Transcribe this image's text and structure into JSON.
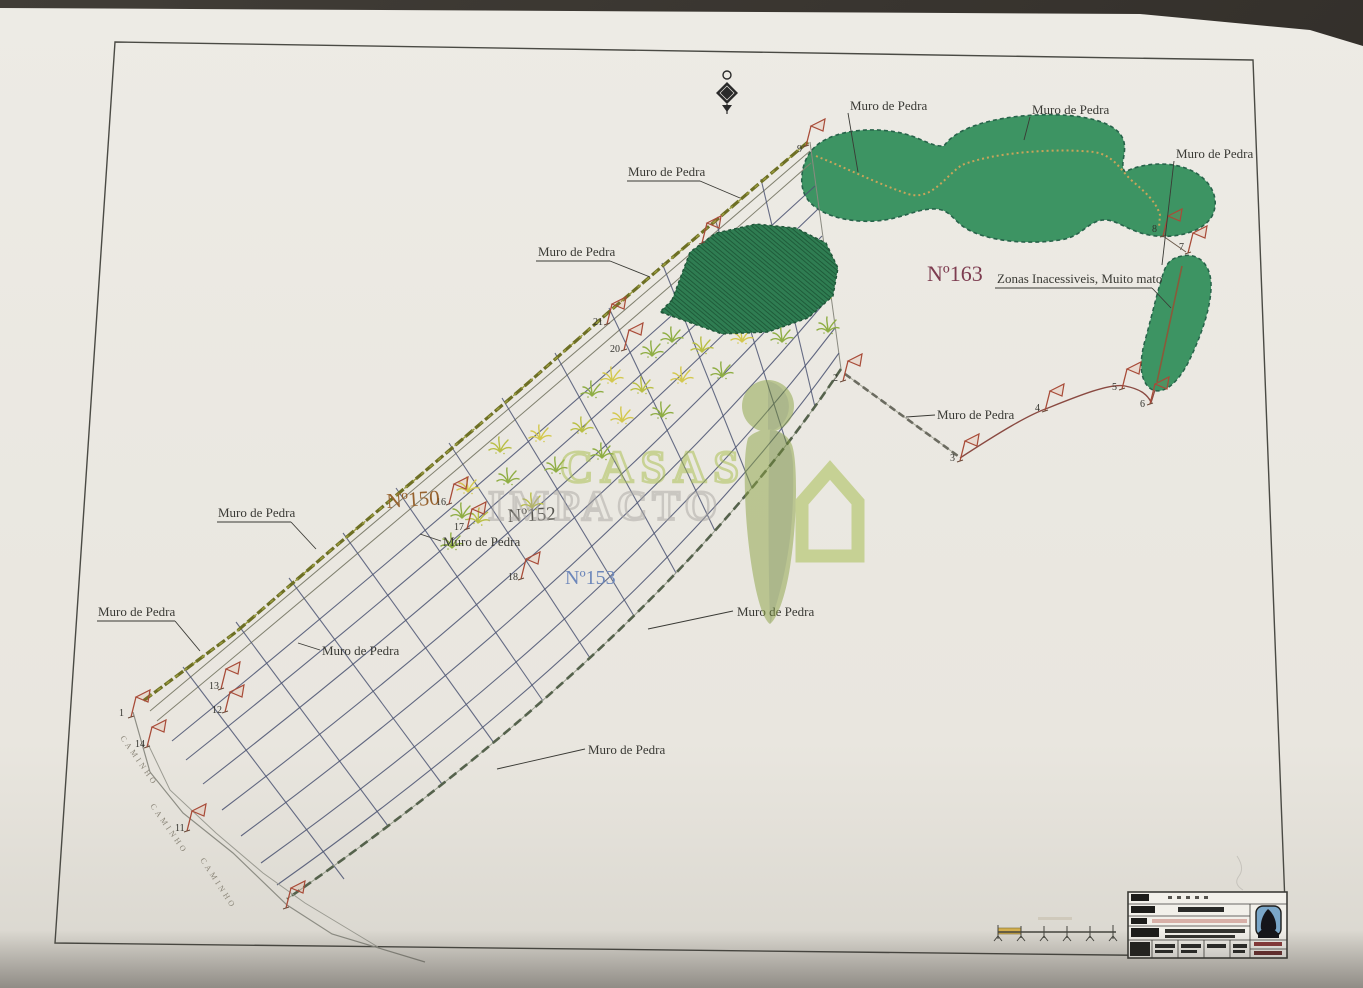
{
  "scene": {
    "background_color": "#37332e",
    "paper_color": "#eae7e0",
    "frame_color": "#4a4a44"
  },
  "watermark": {
    "line1": "CASAS",
    "line2": "IMPACTO",
    "color_line1": "#a6bd4a",
    "color_line2": "#aaa7a2",
    "logo_color": "#8ba344"
  },
  "parcel_labels": [
    {
      "text": "Nº150",
      "color": "#96622e"
    },
    {
      "text": "Nº152",
      "color": "#55544e"
    },
    {
      "text": "Nº153",
      "color": "#6d87ba"
    },
    {
      "text": "Nº163",
      "color": "#7d3c50"
    }
  ],
  "muro_labels": [
    {
      "text": "Muro de Pedra"
    },
    {
      "text": "Muro de Pedra"
    },
    {
      "text": "Muro de Pedra"
    },
    {
      "text": "Muro de Pedra"
    },
    {
      "text": "Muro de Pedra"
    },
    {
      "text": "Muro de Pedra"
    },
    {
      "text": "Muro de Pedra"
    },
    {
      "text": "Muro de Pedra"
    },
    {
      "text": "Muro de Pedra"
    },
    {
      "text": "Muro de Pedra"
    },
    {
      "text": "Muro de Pedra"
    },
    {
      "text": "Muro de Pedra"
    }
  ],
  "zonas_label": {
    "text": "Zonas Inacessiveis, Muito mato"
  },
  "road_label": {
    "text": "CAMINHO"
  },
  "flags": {
    "numbers": [
      "9",
      "8",
      "7",
      "6",
      "5",
      "4",
      "3",
      "2",
      "21",
      "20",
      "16",
      "17",
      "18",
      "13",
      "12",
      "1",
      "14",
      "11"
    ]
  },
  "map_colors": {
    "vegetation_green": "#3d9463",
    "dense_vegetation": "#2f7d52",
    "stone_wall_olive": "#6d6f24",
    "grid_navy": "#4e5674",
    "boundary_brown": "#8a4a42",
    "flag_red": "#a84b38",
    "wall_dotted_tan": "#c9a45a",
    "scalebar_yellow": "#d2ae4e",
    "titleblock_logo_blue": "#7aa6c8"
  }
}
